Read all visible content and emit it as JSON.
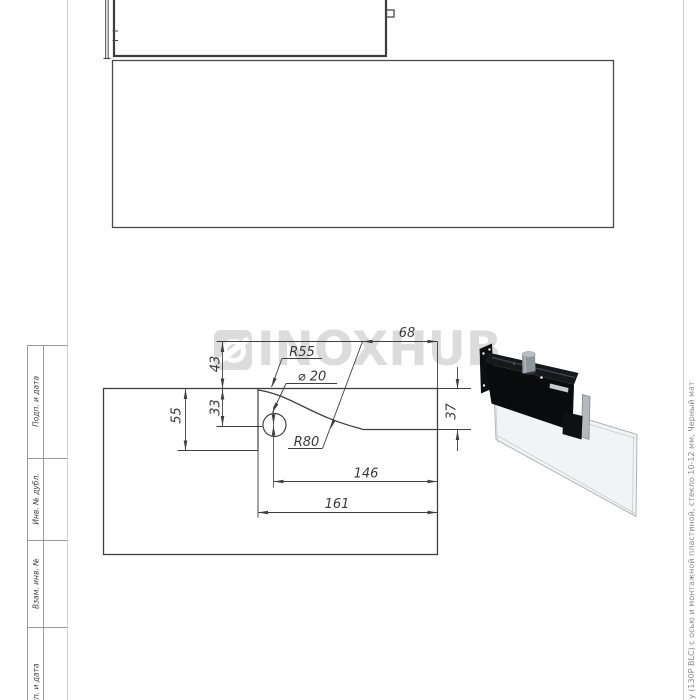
{
  "watermark": {
    "brand": "INOXHUB"
  },
  "dims": {
    "d68": "68",
    "d43": "43",
    "d33": "33",
    "d55": "55",
    "d37": "37",
    "d146": "146",
    "d161": "161",
    "r55": "R55",
    "r80": "R80",
    "hole": "⌀ 20"
  },
  "title_block": {
    "cells": [
      {
        "label": "Подп. и дата"
      },
      {
        "label": "Инв. № дубл."
      },
      {
        "label": "Взам. инв. №"
      },
      {
        "label": "Подп. и дата"
      }
    ]
  },
  "margin_note": "у (130Р BLC) с осью и монтажной пластиной, стекло 10-12 мм, Черный мат"
}
